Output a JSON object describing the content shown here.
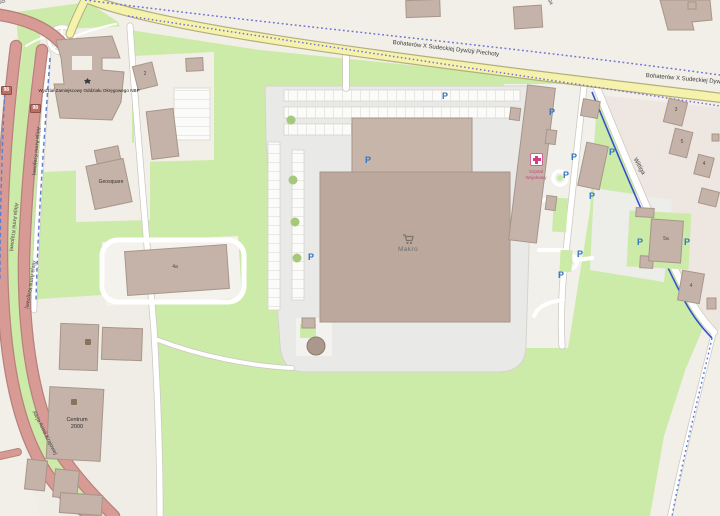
{
  "map_type": "openstreetmap-rendered-tile",
  "colors": {
    "grass": "#cdeba8",
    "background": "#f2efe9",
    "trunk_road": "#d89a94",
    "secondary_road": "#f5f2ae",
    "building": "#c5b2a8",
    "parking_blue": "#2f74c0",
    "hospital_pink": "#d0407e",
    "route_dotted_blue": "#6b74d2",
    "cycleway_blue": "#3353cb"
  },
  "roads": {
    "main": "Bohaterów X Sudeckiej Dywizji Piechoty",
    "left": "Aleja Armii Krajowej",
    "shield": "98",
    "right": "Wittiga",
    "topleft": "Niepodległości"
  },
  "pois": {
    "makro": "Makro",
    "nbp": "Wydział Zamiejscowy Oddziału Okręgowego NBP",
    "geosquare": "Geosquare",
    "hospital_line1": "Szpital",
    "hospital_line2": "Wojskowy",
    "centrum_line1": "Centrum",
    "centrum_line2": "2000",
    "parking_symbol": "P"
  },
  "numbers": {
    "n2": "2",
    "n3": "3",
    "n4": "4",
    "n4a": "4a",
    "n5": "5",
    "n5a": "5a"
  }
}
